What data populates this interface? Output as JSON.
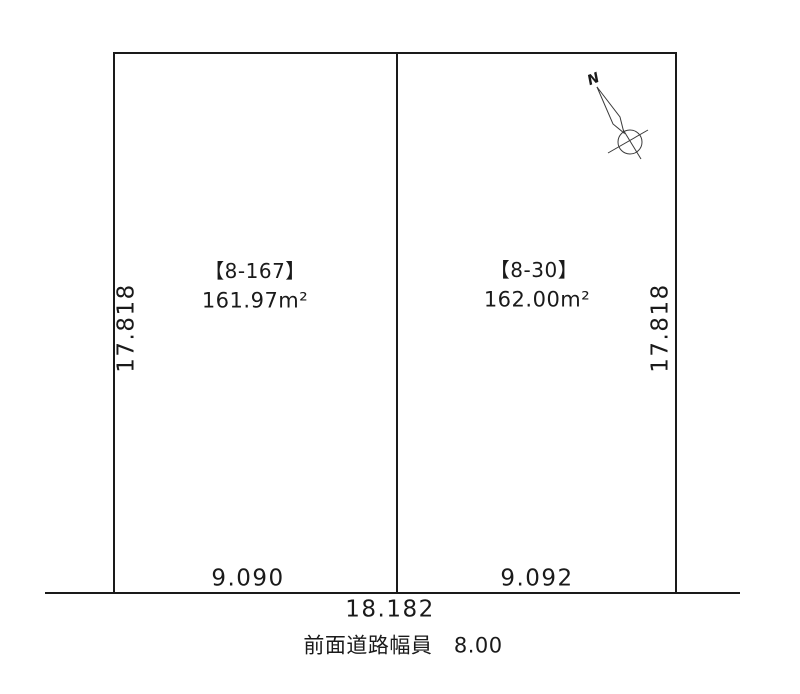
{
  "diagram": {
    "compass": {
      "north_label": "N"
    },
    "parcels": [
      {
        "id_label": "【8-167】",
        "area_label": "161.97m²",
        "frontage_label": "9.090",
        "depth_label": "17.818"
      },
      {
        "id_label": "【8-30】",
        "area_label": "162.00m²",
        "frontage_label": "9.092",
        "depth_label": "17.818"
      }
    ],
    "total_frontage_label": "18.182",
    "road_label": "前面道路幅員　8.00",
    "colors": {
      "line": "#1a1a1a",
      "text": "#1a1a1a",
      "background": "#ffffff"
    }
  }
}
